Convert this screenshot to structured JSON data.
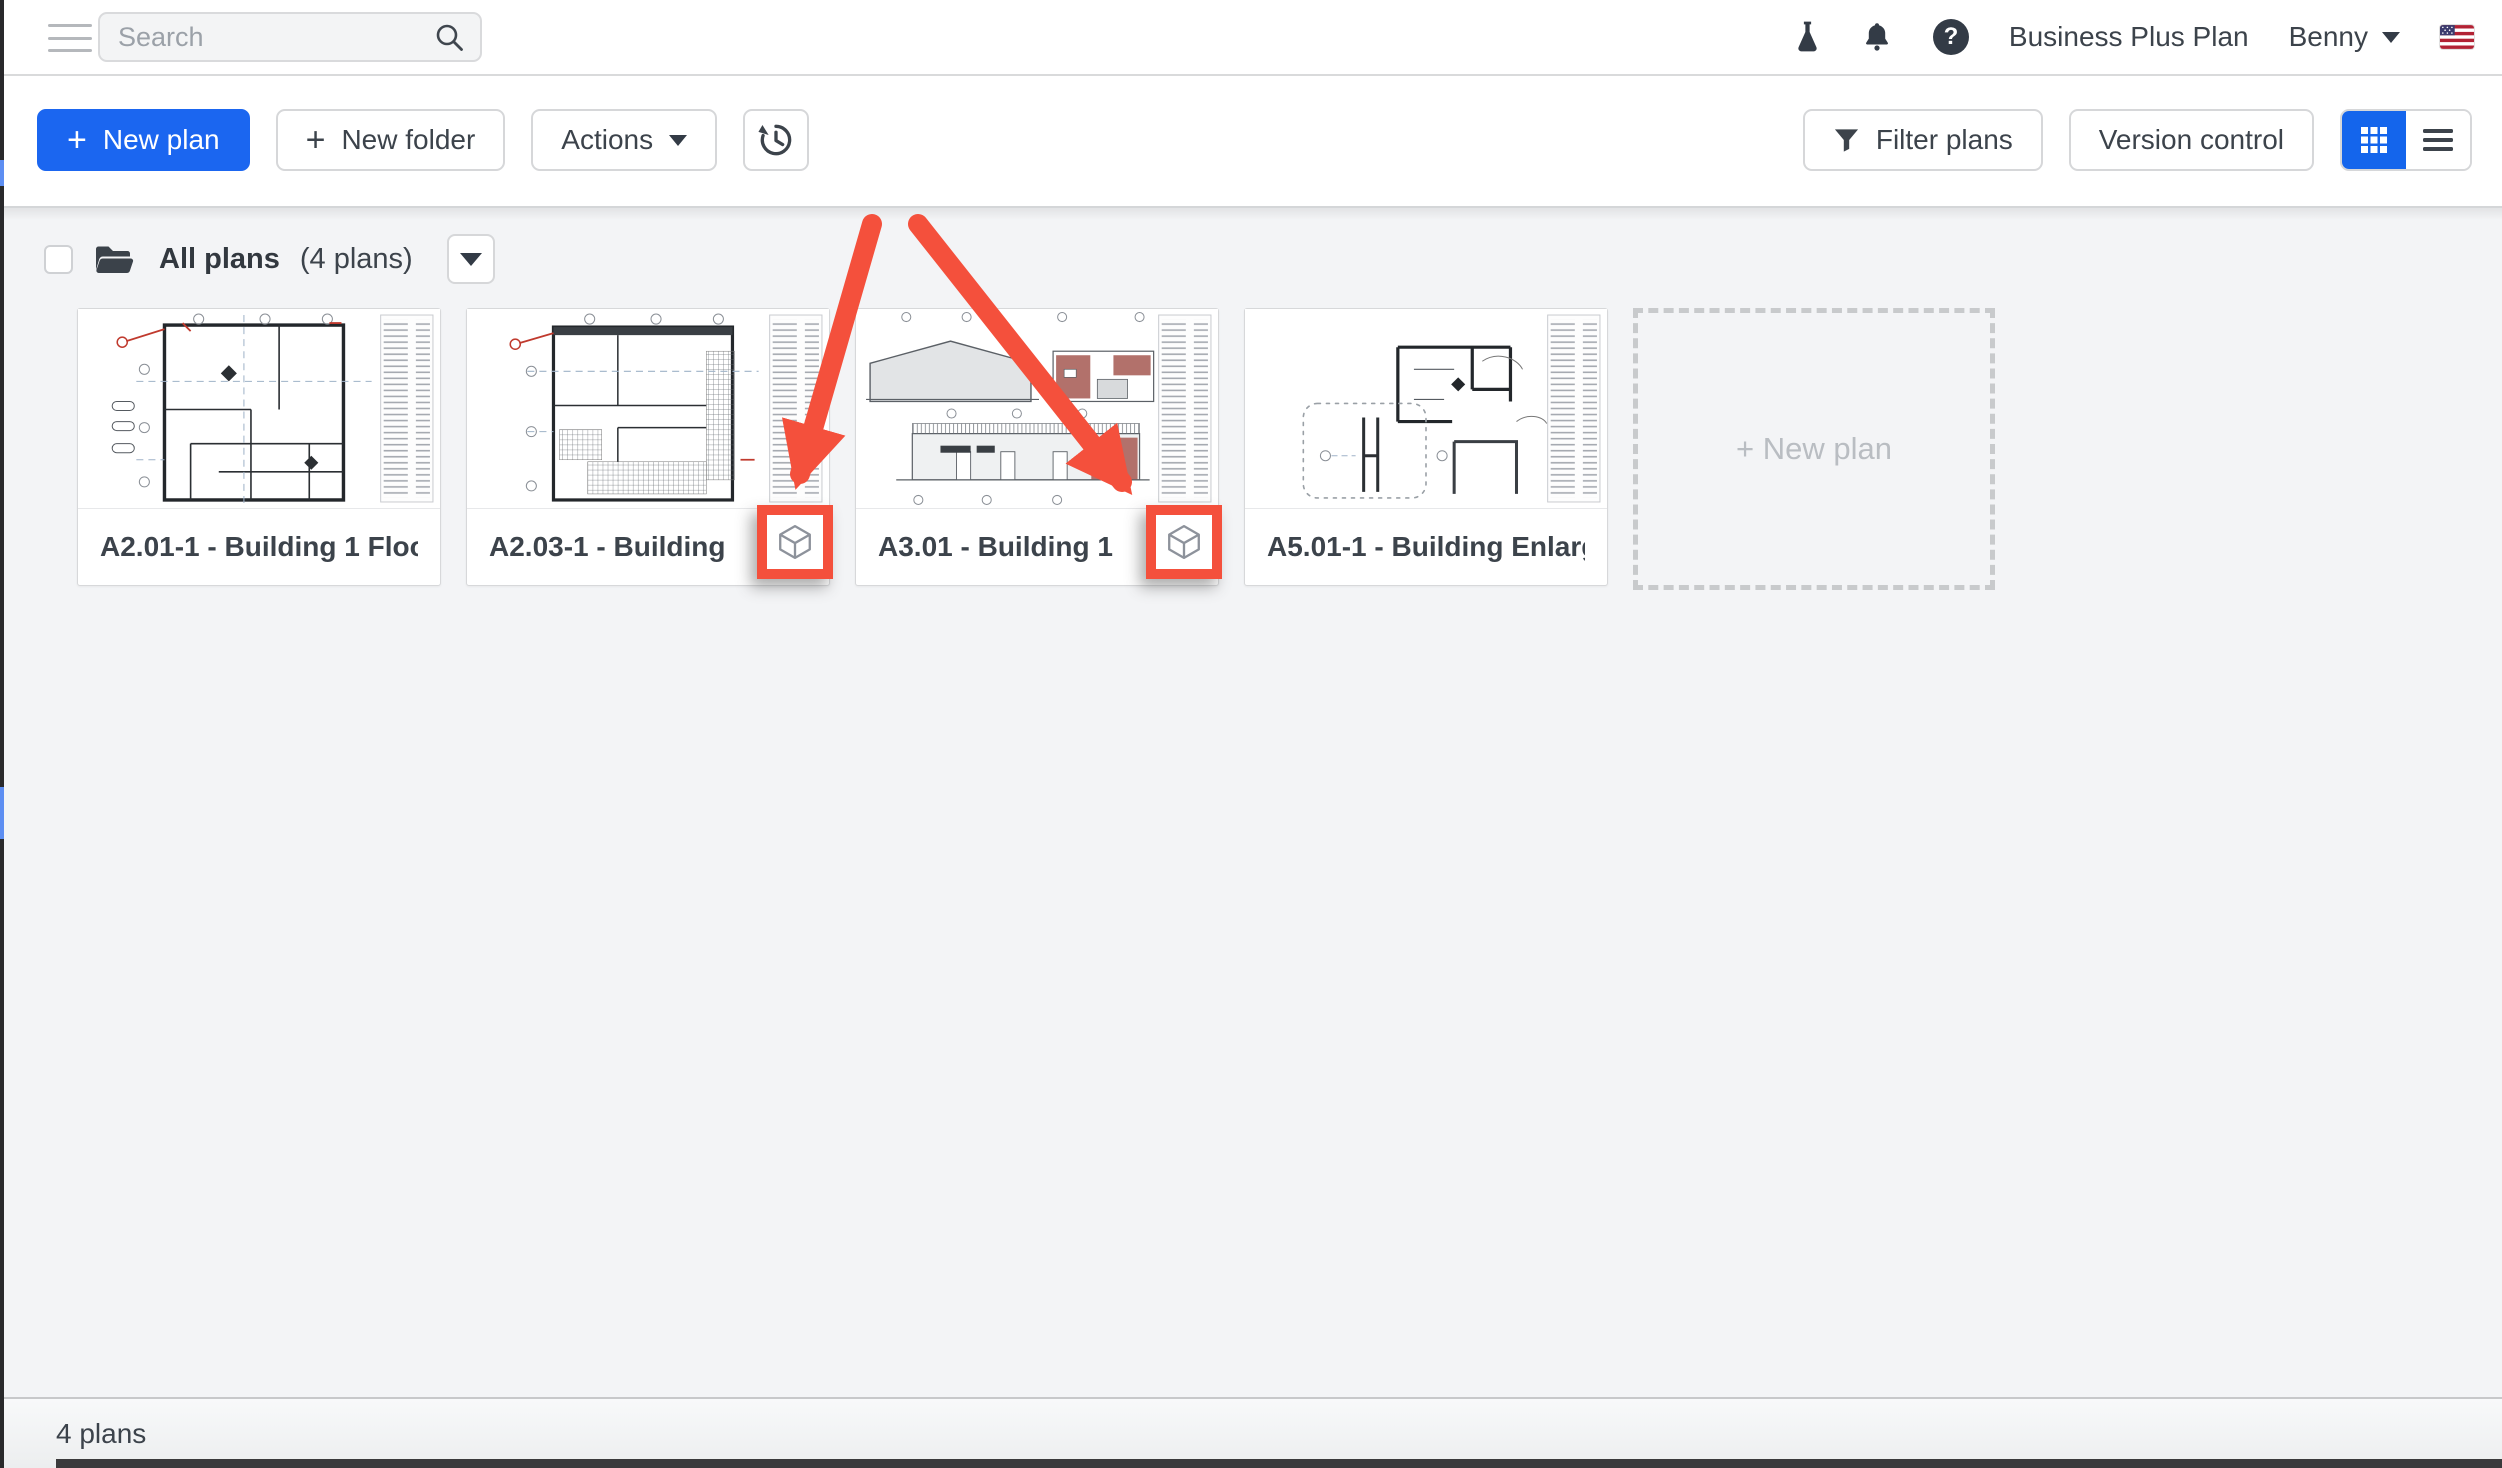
{
  "top_bar": {
    "search_placeholder": "Search",
    "account_plan": "Business Plus Plan",
    "user_name": "Benny",
    "help_glyph": "?"
  },
  "toolbar": {
    "plus_glyph": "+",
    "new_plan": "New plan",
    "new_folder": "New folder",
    "actions": "Actions",
    "filter_plans": "Filter plans",
    "version_control": "Version control"
  },
  "folder_bar": {
    "name": "All plans",
    "count": "(4 plans)"
  },
  "plans": [
    {
      "title": "A2.01-1 - Building 1 Floor ...",
      "has_3d_badge": false
    },
    {
      "title": "A2.03-1 - Building 1 C...",
      "has_3d_badge": true
    },
    {
      "title": "A3.01 - Building 1 Elev...",
      "has_3d_badge": true
    },
    {
      "title": "A5.01-1 - Building Enlarge...",
      "has_3d_badge": false
    }
  ],
  "new_plan_placeholder": "+ New plan",
  "footer": {
    "count_label": "4 plans"
  },
  "icons": {
    "search": "magnifier",
    "beta": "flask",
    "notifications": "bell",
    "help": "question-mark-circle",
    "language": "us-flag",
    "history": "clock-restore",
    "filter": "funnel",
    "view_grid": "grid-3x3",
    "view_list": "list-lines",
    "folder": "open-folder",
    "plan_3d": "cube"
  },
  "colors": {
    "accent_blue": "#1b66f0",
    "annotation_red": "#f4503c",
    "icon_dark": "#333b46",
    "content_bg": "#f3f4f6"
  },
  "annotations": {
    "arrow_count": 2,
    "highlight_box_count": 2,
    "arrow_color": "#f4503c"
  }
}
